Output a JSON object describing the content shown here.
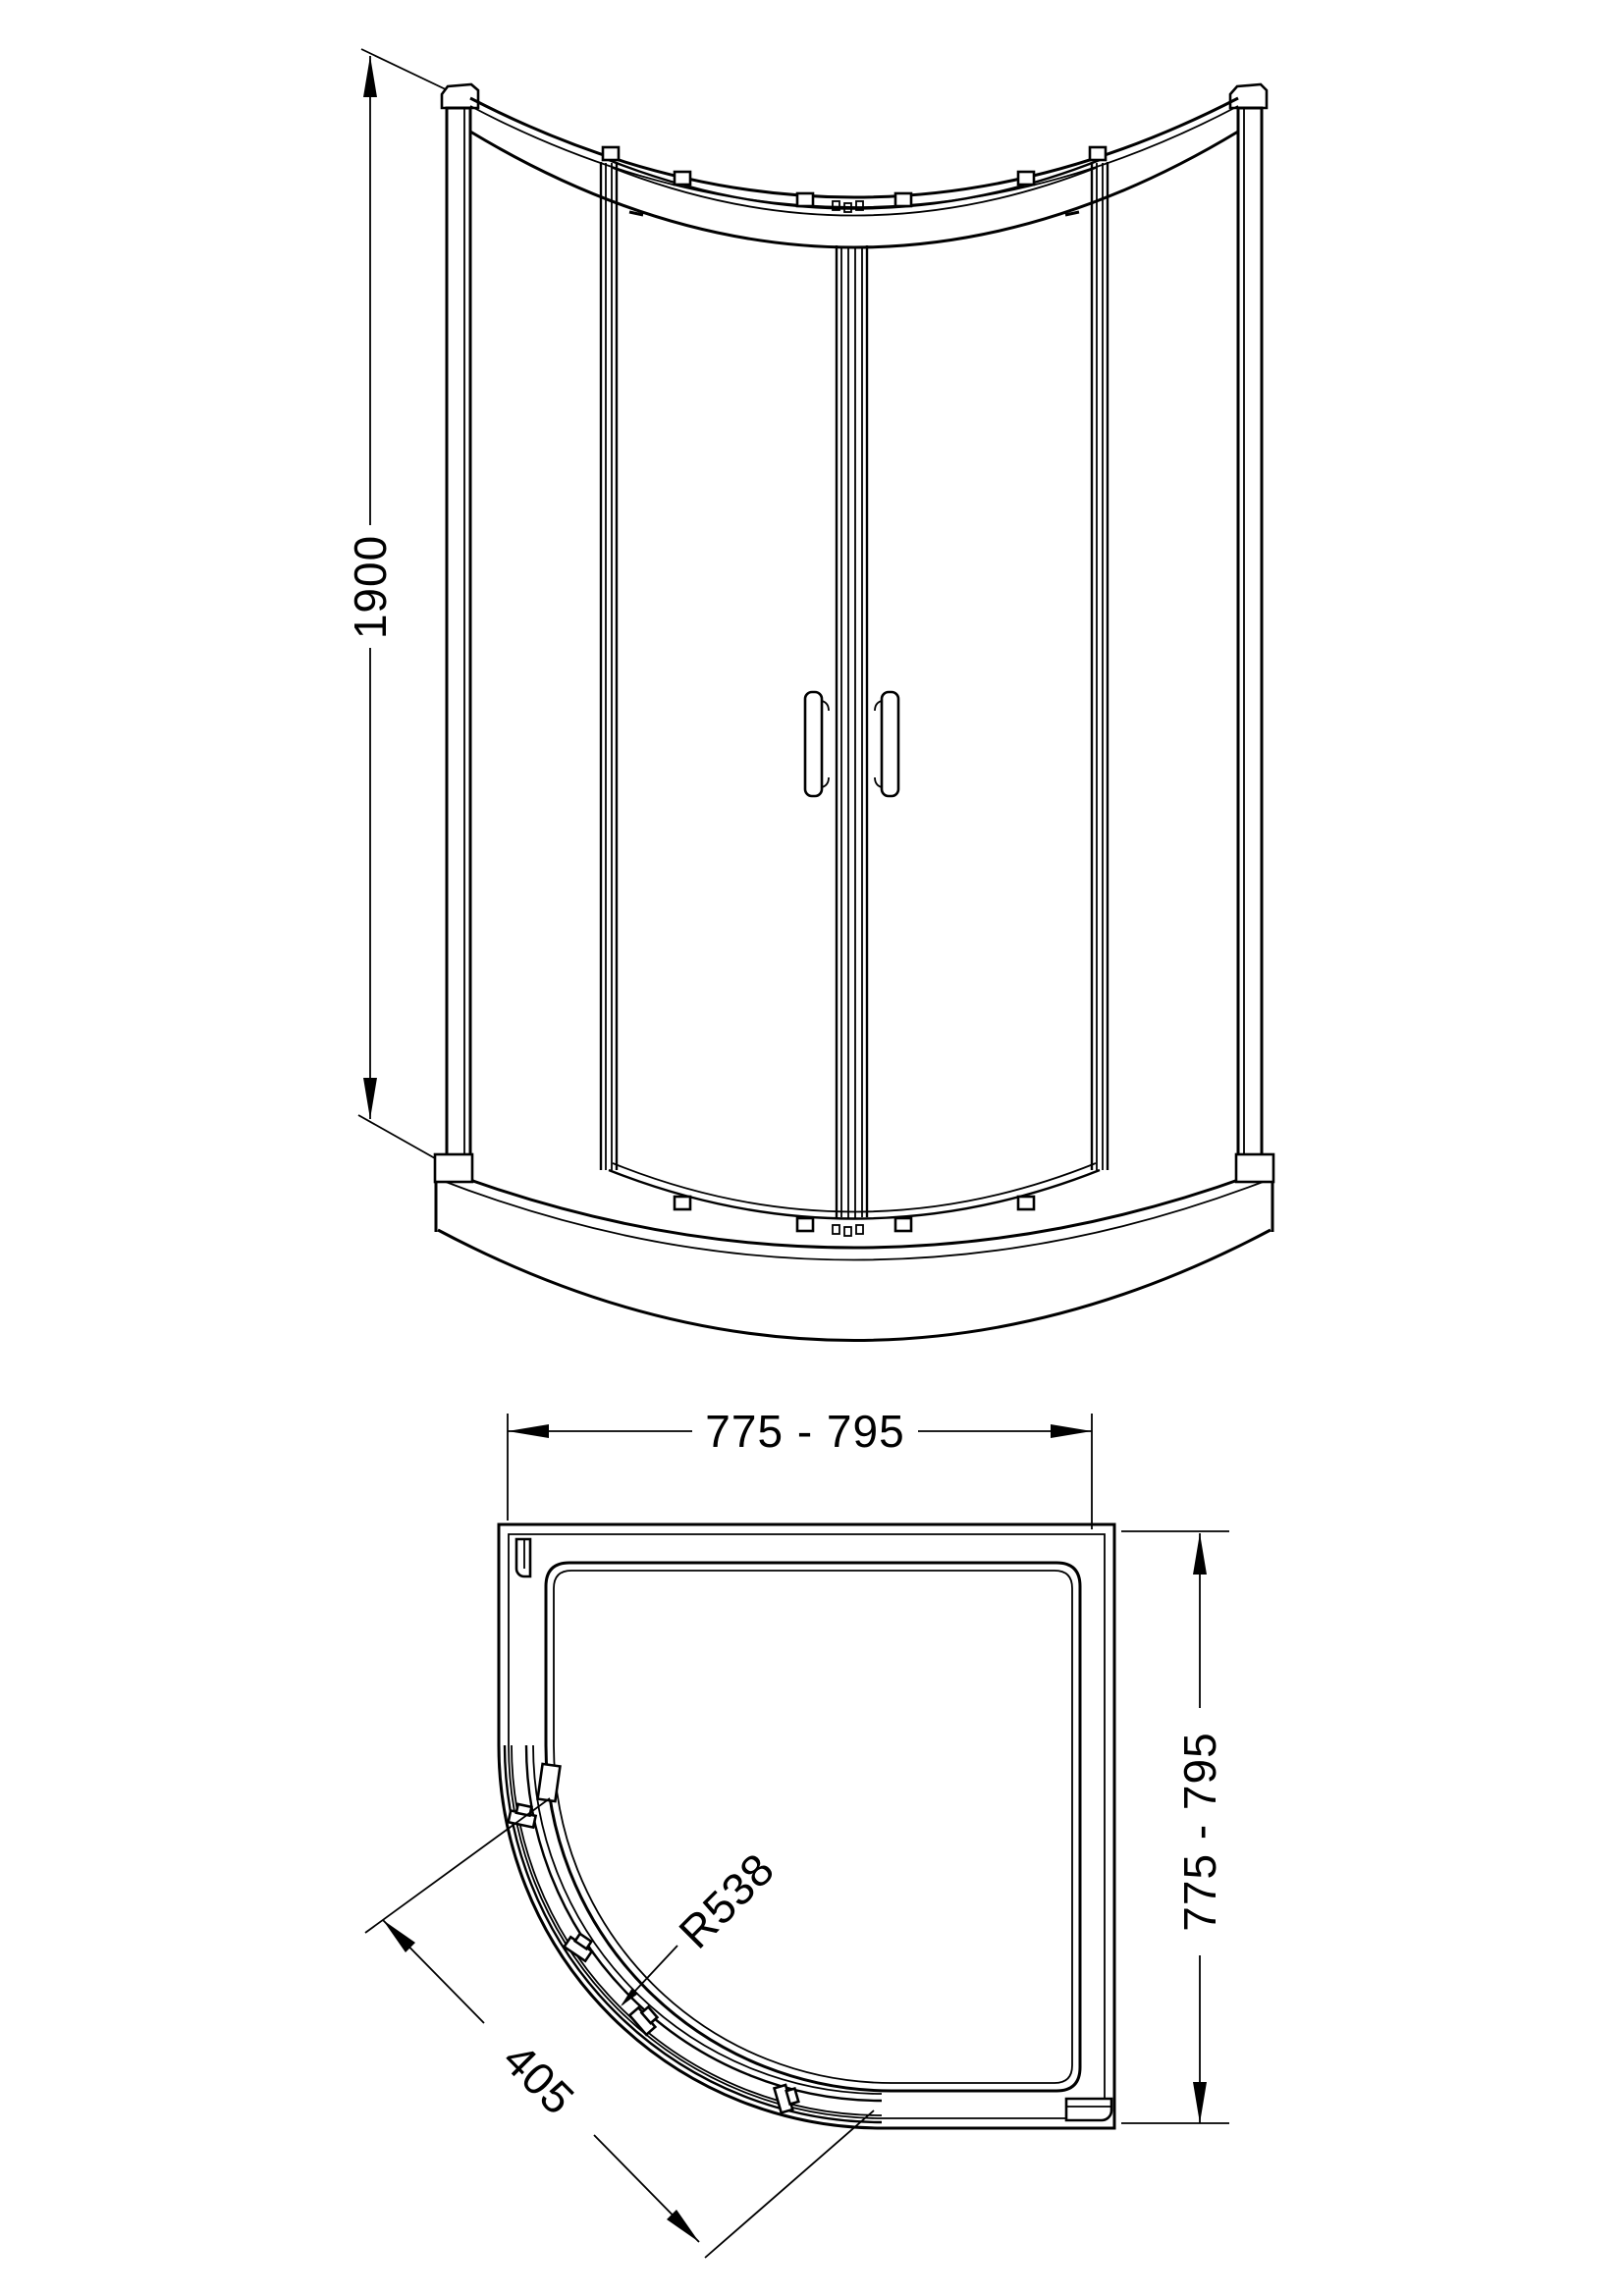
{
  "drawing": {
    "background": "#ffffff",
    "line_color": "#000000"
  },
  "dimensions": {
    "height": "1900",
    "width": "775 - 795",
    "depth": "775 - 795",
    "radius": "R538",
    "door_opening": "405"
  }
}
